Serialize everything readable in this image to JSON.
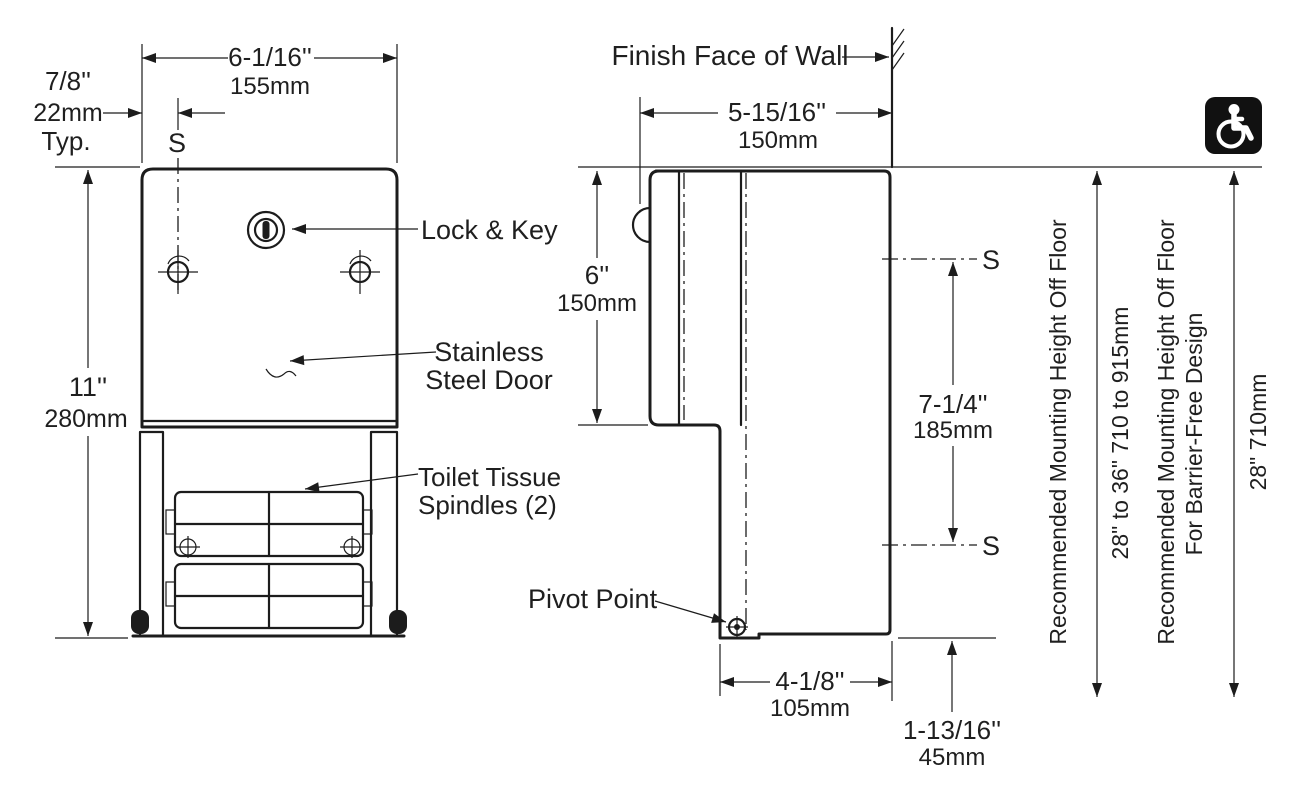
{
  "front_view": {
    "width_in": "6-1/16''",
    "width_mm": "155mm",
    "edge_offset_in": "7/8''",
    "edge_offset_mm": "22mm",
    "edge_offset_note": "Typ.",
    "centerline_label": "S",
    "height_in": "11''",
    "height_mm": "280mm",
    "lock_label": "Lock & Key",
    "door_label_line1": "Stainless",
    "door_label_line2": "Steel Door",
    "spindles_label_line1": "Toilet Tissue",
    "spindles_label_line2": "Spindles (2)"
  },
  "side_view": {
    "wall_label": "Finish Face of Wall",
    "depth_in": "5-15/16''",
    "depth_mm": "150mm",
    "top_to_door_in": "6''",
    "top_to_door_mm": "150mm",
    "centerline_upper_label": "S",
    "centerline_lower_label": "S",
    "centerline_spacing_in": "7-1/4''",
    "centerline_spacing_mm": "185mm",
    "pivot_label": "Pivot Point",
    "base_depth_in": "4-1/8''",
    "base_depth_mm": "105mm",
    "bottom_offset_in": "1-13/16''",
    "bottom_offset_mm": "45mm"
  },
  "mounting": {
    "standard_label": "Recommended Mounting Height Off Floor",
    "standard_range": "28\" to 36\"  710 to 915mm",
    "barrier_free_label_line1": "Recommended Mounting Height Off Floor",
    "barrier_free_label_line2": "For Barrier-Free Design",
    "barrier_free_range": "28\"  710mm"
  },
  "icons": {
    "accessibility": "wheelchair-accessibility-symbol"
  },
  "colors": {
    "line": "#1c1c1c",
    "text": "#1f1f1f",
    "background": "#ffffff",
    "icon_background": "#111111",
    "icon_glyph": "#ffffff"
  }
}
